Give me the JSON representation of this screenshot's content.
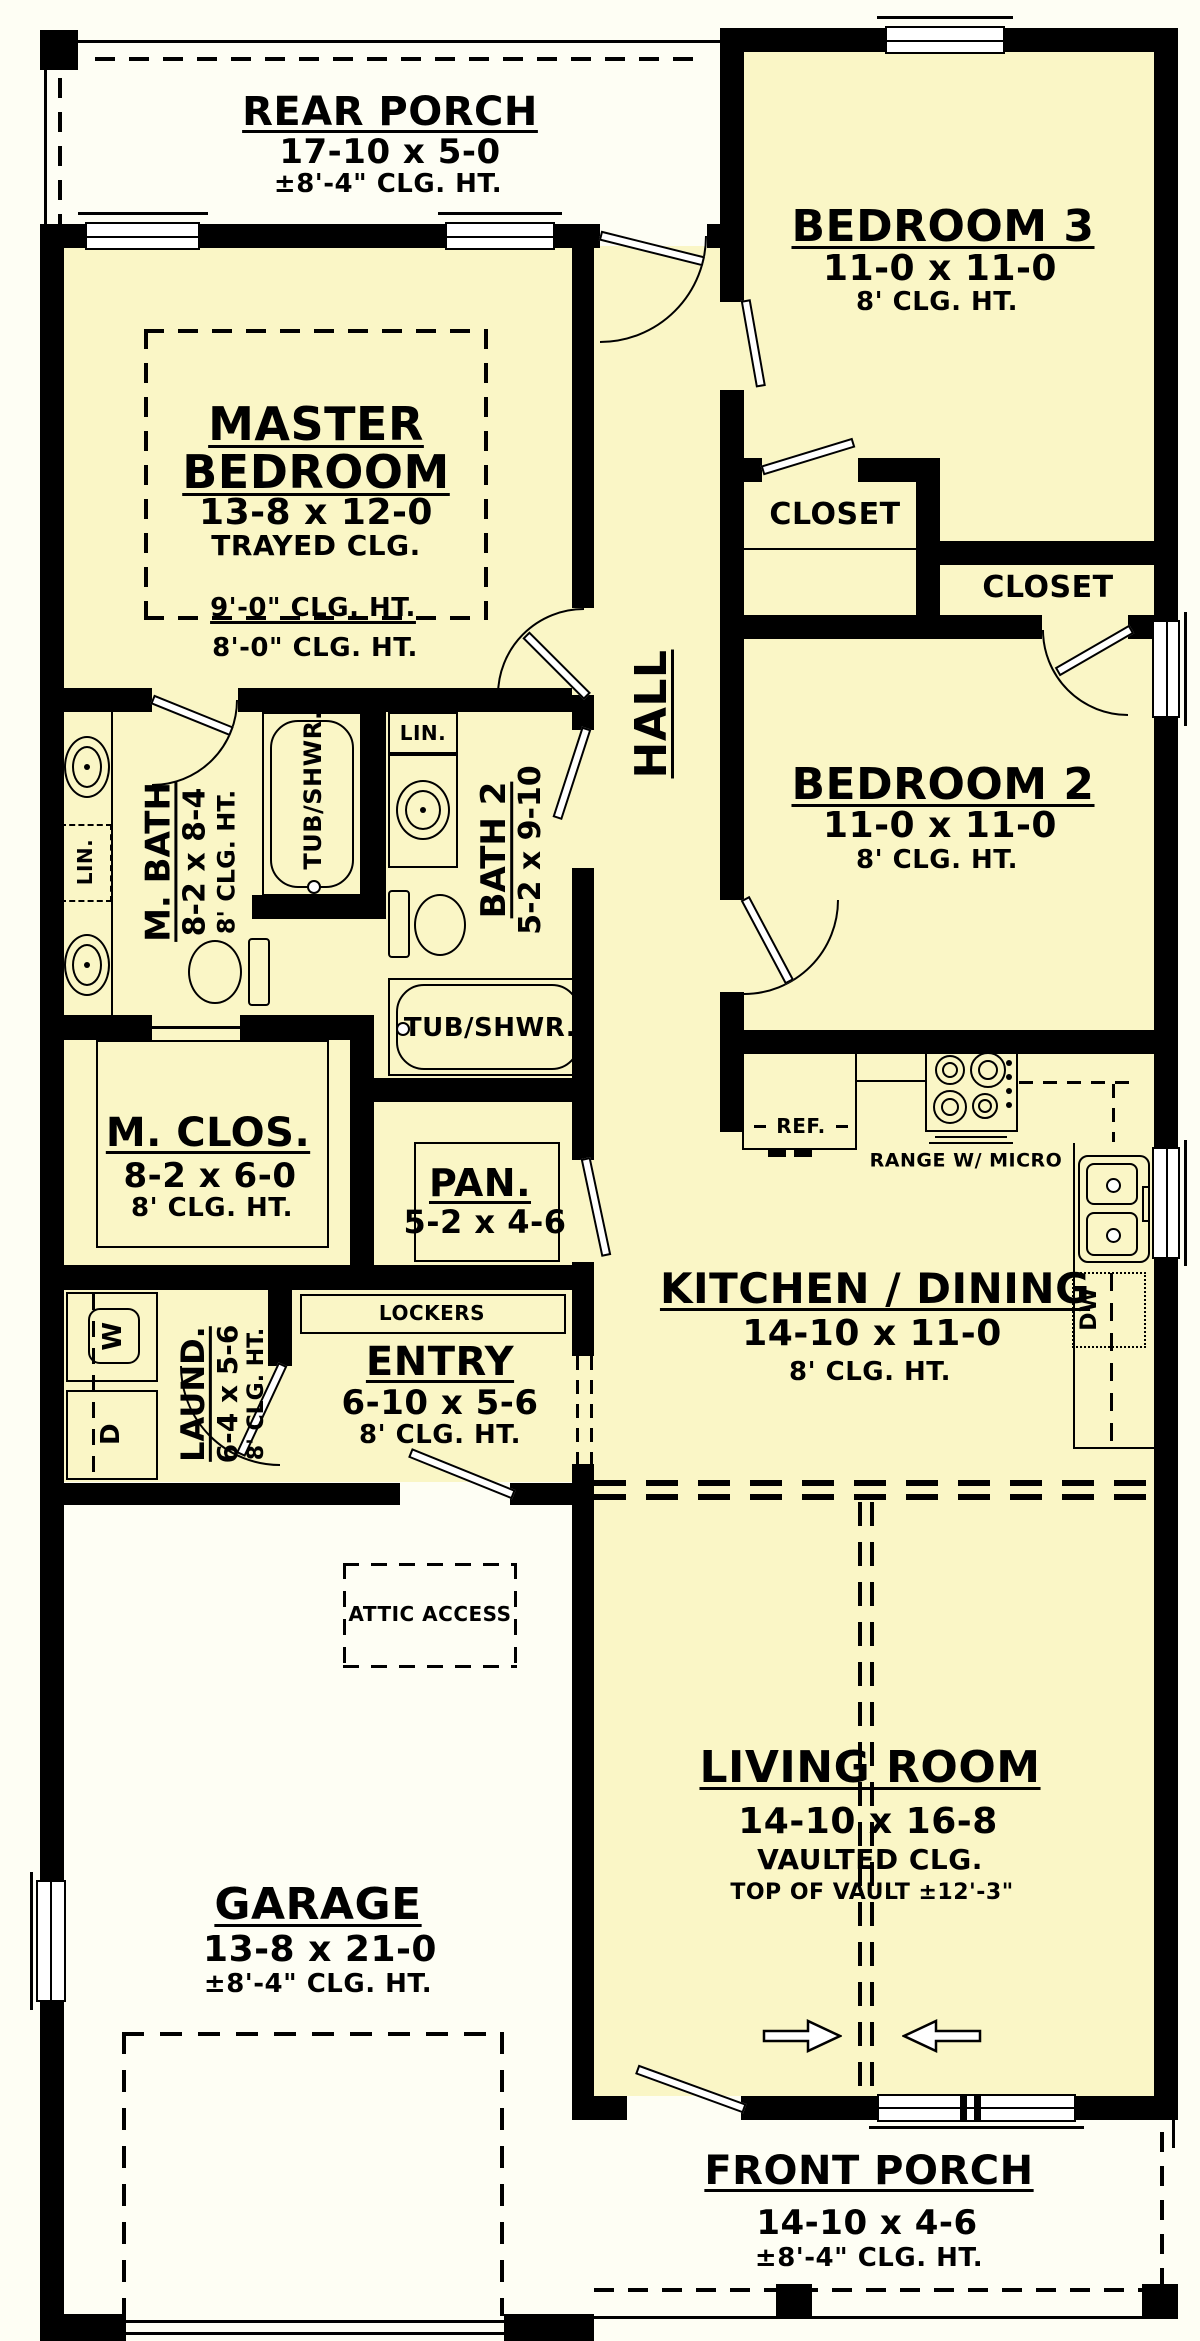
{
  "plan": {
    "colors": {
      "interior": "#FAF6C6",
      "exterior": "#FEFEF4",
      "wall": "#000000"
    },
    "rooms": {
      "rear_porch": {
        "name": "REAR PORCH",
        "dims": "17-10 x 5-0",
        "clg": "±8'-4\" CLG. HT."
      },
      "bedroom3": {
        "name": "BEDROOM 3",
        "dims": "11-0 x 11-0",
        "clg": "8' CLG. HT."
      },
      "master": {
        "name1": "MASTER",
        "name2": "BEDROOM",
        "dims": "13-8 x 12-0",
        "clg": "TRAYED CLG.",
        "tray_clg": "9'-0\" CLG. HT.",
        "low_clg": "8'-0\" CLG. HT."
      },
      "closet_bedroom3": {
        "name": "CLOSET"
      },
      "closet_bedroom2": {
        "name": "CLOSET"
      },
      "hall": {
        "name": "HALL"
      },
      "bedroom2": {
        "name": "BEDROOM 2",
        "dims": "11-0 x 11-0",
        "clg": "8' CLG. HT."
      },
      "m_bath": {
        "name": "M. BATH",
        "dims": "8-2 x 8-4",
        "clg": "8' CLG. HT."
      },
      "bath2": {
        "name": "BATH 2",
        "dims": "5-2 x 9-10"
      },
      "m_clos": {
        "name": "M. CLOS.",
        "dims": "8-2 x 6-0",
        "clg": "8' CLG. HT."
      },
      "pantry": {
        "name": "PAN.",
        "dims": "5-2 x 4-6"
      },
      "kitchen": {
        "name": "KITCHEN / DINING",
        "dims": "14-10 x 11-0",
        "clg": "8' CLG. HT."
      },
      "laundry": {
        "name": "LAUND.",
        "dims": "6-4 x 5-6",
        "clg": "8' CLG. HT."
      },
      "entry": {
        "name": "ENTRY",
        "dims": "6-10 x 5-6",
        "clg": "8' CLG. HT."
      },
      "garage": {
        "name": "GARAGE",
        "dims": "13-8 x 21-0",
        "clg": "±8'-4\" CLG. HT."
      },
      "living": {
        "name": "LIVING ROOM",
        "dims": "14-10 x 16-8",
        "clg": "VAULTED CLG.",
        "vault_note": "TOP OF VAULT ±12'-3\""
      },
      "front_porch": {
        "name": "FRONT PORCH",
        "dims": "14-10 x 4-6",
        "clg": "±8'-4\" CLG. HT."
      }
    },
    "fixtures": {
      "ref": "REF.",
      "range": "RANGE W/ MICRO",
      "dw": "DW",
      "washer": "W",
      "dryer": "D",
      "lockers": "LOCKERS",
      "attic_access": "ATTIC ACCESS",
      "master_tub": "TUB/SHWR.",
      "bath2_tub": "TUB/SHWR.",
      "master_linen": "LIN.",
      "bath2_linen": "LIN."
    }
  }
}
